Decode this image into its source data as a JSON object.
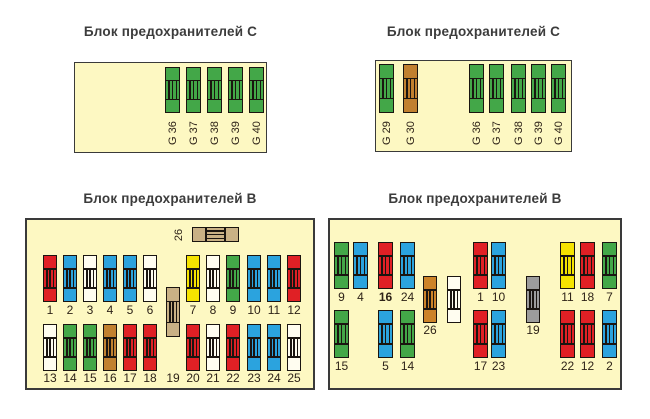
{
  "diagram": {
    "kind": "fuse-box-diagram",
    "language": "ru"
  },
  "colors": {
    "panel_bg": "#FDF8C2",
    "red": "#E02025",
    "blue": "#2BA3DE",
    "green": "#43A748",
    "yellow": "#F5E300",
    "white": "#FFFDF0",
    "brown": "#C1802F",
    "orange": "#CC8328",
    "tan": "#C9B185",
    "gray": "#9C9C9C"
  },
  "panels": [
    {
      "title": "Блок предохранителей C",
      "title_pos": {
        "x": 74,
        "y": 24,
        "w": 193
      },
      "frame": {
        "x": 74,
        "y": 62,
        "w": 193,
        "h": 91,
        "border": 1
      },
      "groups": [
        {
          "y": 4,
          "h": 46,
          "w": 15,
          "label": {
            "mode": "rot-below",
            "y": 50
          },
          "fuses": [
            {
              "x": 90,
              "label": "G 36",
              "color": "green"
            },
            {
              "x": 111,
              "label": "G 37",
              "color": "green"
            },
            {
              "x": 132,
              "label": "G 38",
              "color": "green"
            },
            {
              "x": 153,
              "label": "G 39",
              "color": "green"
            },
            {
              "x": 174,
              "label": "G 40",
              "color": "green"
            }
          ]
        }
      ]
    },
    {
      "title": "Блок предохранителей C",
      "title_pos": {
        "x": 375,
        "y": 24,
        "w": 197
      },
      "frame": {
        "x": 375,
        "y": 60,
        "w": 197,
        "h": 92,
        "border": 1
      },
      "groups": [
        {
          "y": 3,
          "h": 49,
          "w": 15,
          "label": {
            "mode": "rot-below",
            "y": 52
          },
          "fuses": [
            {
              "x": 3,
              "label": "G 29",
              "color": "green"
            },
            {
              "x": 27,
              "label": "G 30",
              "color": "brown"
            },
            {
              "x": 93,
              "label": "G 36",
              "color": "green"
            },
            {
              "x": 113,
              "label": "G 37",
              "color": "green"
            },
            {
              "x": 135,
              "label": "G 38",
              "color": "green"
            },
            {
              "x": 155,
              "label": "G 39",
              "color": "green"
            },
            {
              "x": 175,
              "label": "G 40",
              "color": "green"
            }
          ]
        }
      ]
    },
    {
      "title": "Блок предохранителей B",
      "title_pos": {
        "x": 25,
        "y": 191,
        "w": 290
      },
      "frame": {
        "x": 25,
        "y": 218,
        "w": 290,
        "h": 172,
        "border": 2
      },
      "groups": [
        {
          "orient": "h",
          "label": {
            "mode": "rot-left"
          },
          "fuses": [
            {
              "x": 165,
              "y": 7,
              "w": 47,
              "h": 15,
              "label": "26",
              "color": "tan"
            }
          ]
        },
        {
          "y": 35,
          "h": 47,
          "w": 14,
          "label": {
            "mode": "below",
            "y": 84
          },
          "fuses": [
            {
              "x": 16,
              "label": "1",
              "color": "red"
            },
            {
              "x": 36,
              "label": "2",
              "color": "blue"
            },
            {
              "x": 56,
              "label": "3",
              "color": "white"
            },
            {
              "x": 76,
              "label": "4",
              "color": "blue"
            },
            {
              "x": 96,
              "label": "5",
              "color": "blue"
            },
            {
              "x": 116,
              "label": "6",
              "color": "white"
            },
            {
              "x": 159,
              "label": "7",
              "color": "yellow"
            },
            {
              "x": 179,
              "label": "8",
              "color": "white"
            },
            {
              "x": 199,
              "label": "9",
              "color": "green"
            },
            {
              "x": 220,
              "label": "10",
              "color": "blue"
            },
            {
              "x": 240,
              "label": "11",
              "color": "blue"
            },
            {
              "x": 260,
              "label": "12",
              "color": "red"
            }
          ]
        },
        {
          "y": 67,
          "h": 50,
          "w": 14,
          "label": {
            "mode": "below",
            "y": 152
          },
          "fuses": [
            {
              "x": 139,
              "label": "19",
              "color": "tan"
            }
          ]
        },
        {
          "y": 104,
          "h": 47,
          "w": 14,
          "label": {
            "mode": "below",
            "y": 152
          },
          "fuses": [
            {
              "x": 16,
              "label": "13",
              "color": "white"
            },
            {
              "x": 36,
              "label": "14",
              "color": "green"
            },
            {
              "x": 56,
              "label": "15",
              "color": "green"
            },
            {
              "x": 76,
              "label": "16",
              "color": "brown"
            },
            {
              "x": 96,
              "label": "17",
              "color": "red"
            },
            {
              "x": 116,
              "label": "18",
              "color": "red"
            },
            {
              "x": 159,
              "label": "20",
              "color": "red"
            },
            {
              "x": 179,
              "label": "21",
              "color": "white"
            },
            {
              "x": 199,
              "label": "22",
              "color": "red"
            },
            {
              "x": 220,
              "label": "23",
              "color": "blue"
            },
            {
              "x": 240,
              "label": "24",
              "color": "blue"
            },
            {
              "x": 260,
              "label": "25",
              "color": "white"
            }
          ]
        }
      ]
    },
    {
      "title": "Блок предохранителей B",
      "title_pos": {
        "x": 328,
        "y": 191,
        "w": 294
      },
      "frame": {
        "x": 328,
        "y": 218,
        "w": 294,
        "h": 172,
        "border": 2
      },
      "groups": [
        {
          "y": 22,
          "h": 47,
          "w": 15,
          "label": {
            "mode": "below",
            "y": 71
          },
          "fuses": [
            {
              "x": 4,
              "label": "9",
              "color": "green"
            },
            {
              "x": 23,
              "label": "4",
              "color": "blue"
            },
            {
              "x": 48,
              "label": "16",
              "color": "red",
              "bold": true
            },
            {
              "x": 70,
              "label": "24",
              "color": "blue"
            },
            {
              "x": 143,
              "label": "1",
              "color": "red"
            },
            {
              "x": 161,
              "label": "10",
              "color": "blue"
            },
            {
              "x": 230,
              "label": "11",
              "color": "yellow"
            },
            {
              "x": 250,
              "label": "18",
              "color": "red"
            },
            {
              "x": 272,
              "label": "7",
              "color": "green"
            }
          ]
        },
        {
          "y": 56,
          "h": 47,
          "w": 14,
          "label": {
            "mode": "below",
            "y": 104
          },
          "fuses": [
            {
              "x": 93,
              "label": "26",
              "color": "orange"
            },
            {
              "x": 117,
              "label": "",
              "color": "white"
            },
            {
              "x": 196,
              "label": "19",
              "color": "gray"
            }
          ]
        },
        {
          "y": 90,
          "h": 48,
          "w": 15,
          "label": {
            "mode": "below",
            "y": 140
          },
          "fuses": [
            {
              "x": 4,
              "label": "15",
              "color": "green"
            },
            {
              "x": 48,
              "label": "5",
              "color": "blue"
            },
            {
              "x": 70,
              "label": "14",
              "color": "green"
            },
            {
              "x": 143,
              "label": "17",
              "color": "red"
            },
            {
              "x": 161,
              "label": "23",
              "color": "blue"
            },
            {
              "x": 230,
              "label": "22",
              "color": "red"
            },
            {
              "x": 250,
              "label": "12",
              "color": "red"
            },
            {
              "x": 272,
              "label": "2",
              "color": "blue"
            }
          ]
        }
      ]
    }
  ]
}
